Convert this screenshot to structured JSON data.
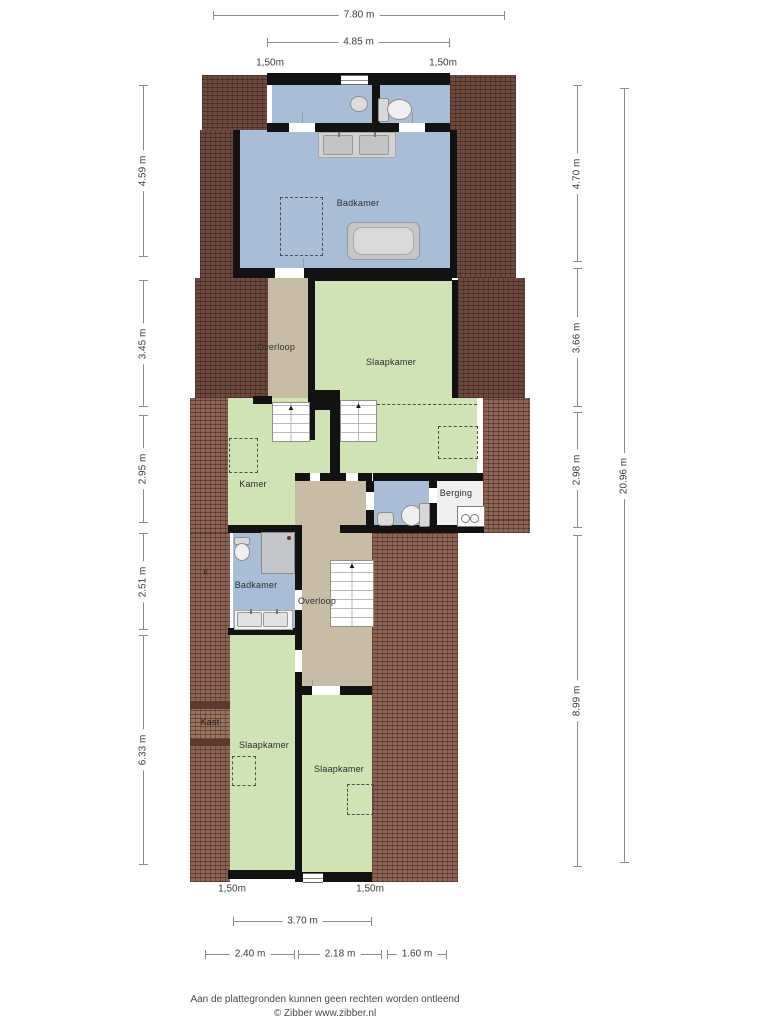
{
  "floorplan": {
    "type": "residential-floorplan",
    "language": "nl",
    "rooms": [
      {
        "name": "badkamer-top",
        "label": "Badkamer"
      },
      {
        "name": "overloop-upper",
        "label": "Overloop"
      },
      {
        "name": "slaapkamer-upper",
        "label": "Slaapkamer"
      },
      {
        "name": "kamer",
        "label": "Kamer"
      },
      {
        "name": "berging",
        "label": "Berging"
      },
      {
        "name": "badkamer-small",
        "label": "Badkamer"
      },
      {
        "name": "overloop-lower",
        "label": "Overloop"
      },
      {
        "name": "kast",
        "label": "Kast"
      },
      {
        "name": "k-marker",
        "label": "K"
      },
      {
        "name": "slaapkamer-left",
        "label": "Slaapkamer"
      },
      {
        "name": "slaapkamer-right",
        "label": "Slaapkamer"
      }
    ],
    "dimensions": {
      "top": [
        "7.80 m",
        "4.85 m",
        "1,50m",
        "1,50m"
      ],
      "bottom": [
        "1,50m",
        "1,50m",
        "3.70 m",
        "2.40 m",
        "2.18 m",
        "1.60 m"
      ],
      "left": [
        "4.59 m",
        "3.45 m",
        "2.95 m",
        "2.51 m",
        "6.33 m"
      ],
      "right": [
        "4.70 m",
        "3.66 m",
        "2.98 m",
        "8.99 m",
        "20.96 m"
      ]
    },
    "footer": {
      "disclaimer": "Aan de plattegronden kunnen geen rechten worden ontleend",
      "credit": "© Zibber www.zibber.nl"
    },
    "colors": {
      "room_blue": "#a9bdd6",
      "room_green": "#cfe3b4",
      "room_tan": "#c8bca6",
      "room_white": "#f0f0f0",
      "roof_dark": "#6d4a3f",
      "roof_light": "#8d6355",
      "wall": "#121212"
    }
  }
}
